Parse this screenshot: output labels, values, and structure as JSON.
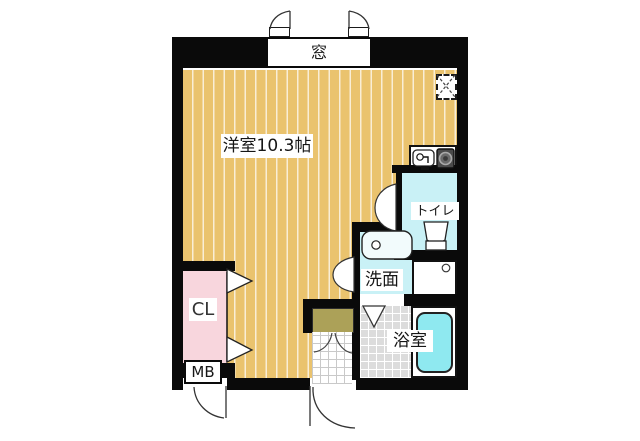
{
  "plan": {
    "title": "apartment-floor-plan",
    "labels": {
      "window": "窓",
      "main_room": "洋室10.3帖",
      "toilet": "トイレ",
      "washroom": "洗面",
      "bathroom": "浴室",
      "closet": "CL",
      "meter_box": "MB"
    },
    "colors": {
      "wall": "#0a0a0a",
      "floor_tan": "#eac36e",
      "room_cyan": "#c9f1f6",
      "bathtub_cyan": "#8fe9f0",
      "closet_pink": "#f8d6dd",
      "entry_step_olive": "#aca158",
      "bath_tile_gray": "#dcdcdc"
    },
    "icons": {
      "kitchen_sink": "sink-icon",
      "kitchen_stove": "stove-icon",
      "toilet_fixture": "toilet-icon",
      "washbasin": "washbasin-icon",
      "washing_machine_pan": "washing-machine-pan-icon",
      "pipe_space": "pipe-space-x-icon"
    }
  }
}
